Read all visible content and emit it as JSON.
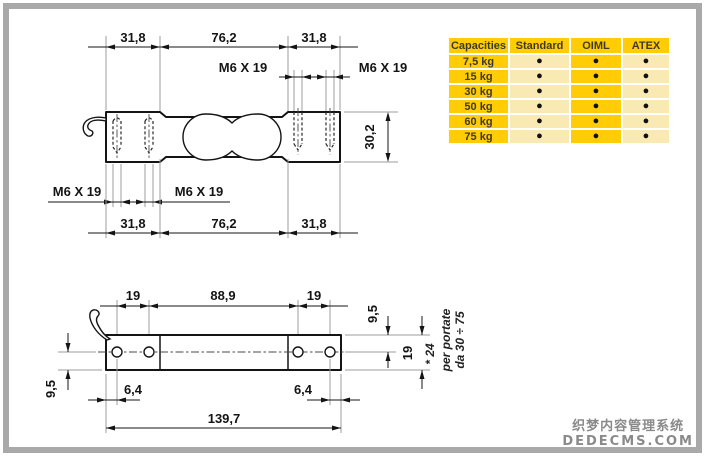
{
  "drawing": {
    "top_view": {
      "dims_top": [
        "31,8",
        "76,2",
        "31,8"
      ],
      "dims_bottom": [
        "31,8",
        "76,2",
        "31,8"
      ],
      "thread_label": "M6 X 19",
      "height_dim": "30,2"
    },
    "side_view": {
      "dims_top": [
        "19",
        "88,9",
        "19"
      ],
      "dim_total": "139,7",
      "dim_hole_offset_left": "6,4",
      "dim_hole_offset_right": "6,4",
      "dim_half_left": "9,5",
      "dim_half_right": "9,5",
      "dim_height": "19",
      "note_alt_height": "* 24",
      "note_capacity_line1": "per portate",
      "note_capacity_line2": "da 30 ÷ 75"
    }
  },
  "capacities_table": {
    "headers": [
      "Capacities",
      "Standard",
      "OIML",
      "ATEX"
    ],
    "rows": [
      {
        "capacity": "7,5 kg",
        "standard": "●",
        "oiml": "●",
        "atex": "●"
      },
      {
        "capacity": "15 kg",
        "standard": "●",
        "oiml": "●",
        "atex": "●"
      },
      {
        "capacity": "30 kg",
        "standard": "●",
        "oiml": "●",
        "atex": "●"
      },
      {
        "capacity": "50 kg",
        "standard": "●",
        "oiml": "●",
        "atex": "●"
      },
      {
        "capacity": "60 kg",
        "standard": "●",
        "oiml": "●",
        "atex": "●"
      },
      {
        "capacity": "75 kg",
        "standard": "●",
        "oiml": "●",
        "atex": "●"
      }
    ],
    "colors": {
      "gold": "#FFCC05",
      "cream": "#F9E9B2"
    }
  },
  "watermark": {
    "line_cn": "织梦内容管理系统",
    "line_en": "DEDECMS.COM"
  },
  "frame_color": "#A9A9A9"
}
